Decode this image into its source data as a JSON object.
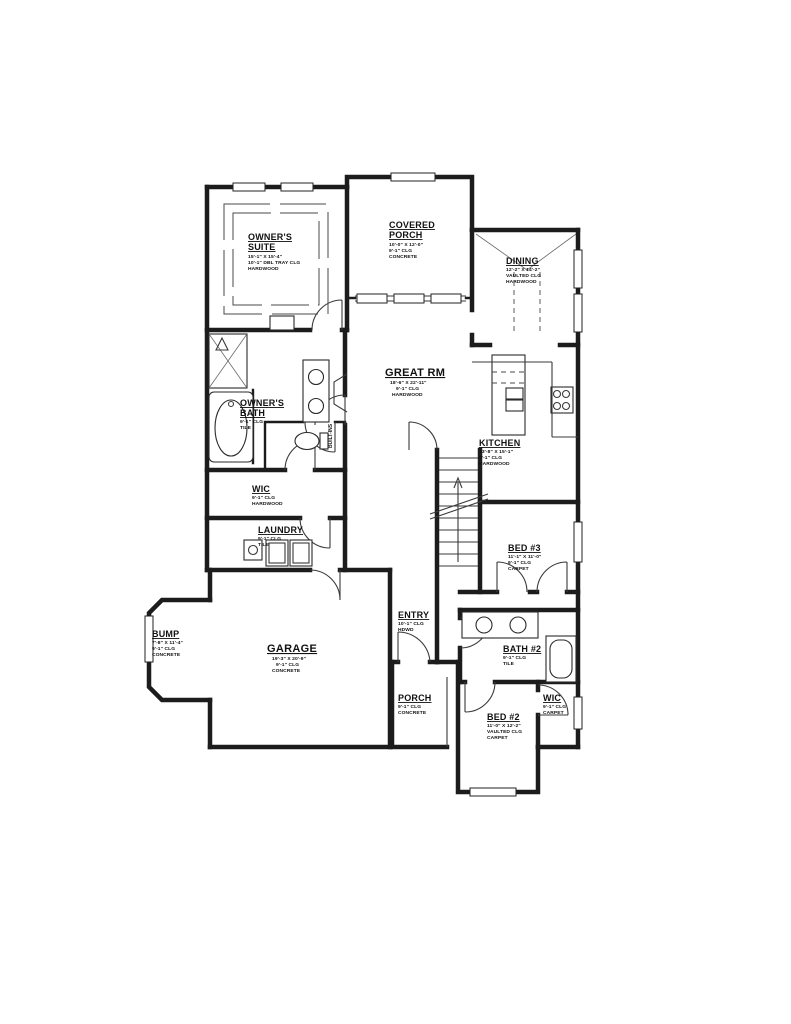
{
  "document": {
    "type": "floor-plan"
  },
  "colors": {
    "wall": "#1c1c1c",
    "thin_line": "#3a3a3a",
    "background": "#ffffff"
  },
  "rooms": {
    "owners_suite": {
      "name1": "OWNER'S",
      "name2": "SUITE",
      "dims": "15'-1\" X 15'-4\"",
      "ceiling": "10'-1\" DBL TRAY CLG",
      "floor": "HARDWOOD"
    },
    "covered_porch": {
      "name1": "COVERED",
      "name2": "PORCH",
      "dims": "10'-0\" X 12'-0\"",
      "ceiling": "9'-1\" CLG",
      "floor": "CONCRETE"
    },
    "dining": {
      "name1": "DINING",
      "dims": "12'-2\" X 14'-2\"",
      "ceiling": "VAULTED CLG",
      "floor": "HARDWOOD"
    },
    "great_rm": {
      "name1": "GREAT RM",
      "dims": "18'-6\" X 22'-11\"",
      "ceiling": "9'-1\" CLG",
      "floor": "HARDWOOD"
    },
    "kitchen": {
      "name1": "KITCHEN",
      "dims": "13'-8\" X 15'-1\"",
      "ceiling": "9'-1\" CLG",
      "floor": "HARDWOOD"
    },
    "owners_bath": {
      "name1": "OWNER'S",
      "name2": "BATH",
      "ceiling": "9'-1\" CLG",
      "floor": "TILE"
    },
    "wic1": {
      "name1": "WIC",
      "ceiling": "9'-1\" CLG",
      "floor": "HARDWOOD"
    },
    "laundry": {
      "name1": "LAUNDRY",
      "ceiling": "9'-1\" CLG",
      "floor": "TILE"
    },
    "bed3": {
      "name1": "BED #3",
      "dims": "11'-1\" X 11'-0\"",
      "ceiling": "9'-1\" CLG",
      "floor": "CARPET"
    },
    "entry": {
      "name1": "ENTRY",
      "ceiling": "10'-1\" CLG",
      "floor": "HDWD"
    },
    "bump": {
      "name1": "BUMP",
      "dims": "7'-8\" X 11'-4\"",
      "ceiling": "9'-1\" CLG",
      "floor": "CONCRETE"
    },
    "garage": {
      "name1": "GARAGE",
      "dims": "19'-3\" X 20'-9\"",
      "ceiling": "9'-1\" CLG",
      "floor": "CONCRETE"
    },
    "bath2": {
      "name1": "BATH #2",
      "ceiling": "9'-1\" CLG",
      "floor": "TILE"
    },
    "porch": {
      "name1": "PORCH",
      "ceiling": "9'-1\" CLG",
      "floor": "CONCRETE"
    },
    "bed2": {
      "name1": "BED #2",
      "dims": "11'-0\" X 12'-2\"",
      "ceiling": "VAULTED CLG",
      "floor": "CARPET"
    },
    "wic2": {
      "name1": "WIC",
      "ceiling": "9'-1\" CLG",
      "floor": "CARPET"
    }
  },
  "annotations": {
    "built_ins": "BUILT-INS"
  }
}
